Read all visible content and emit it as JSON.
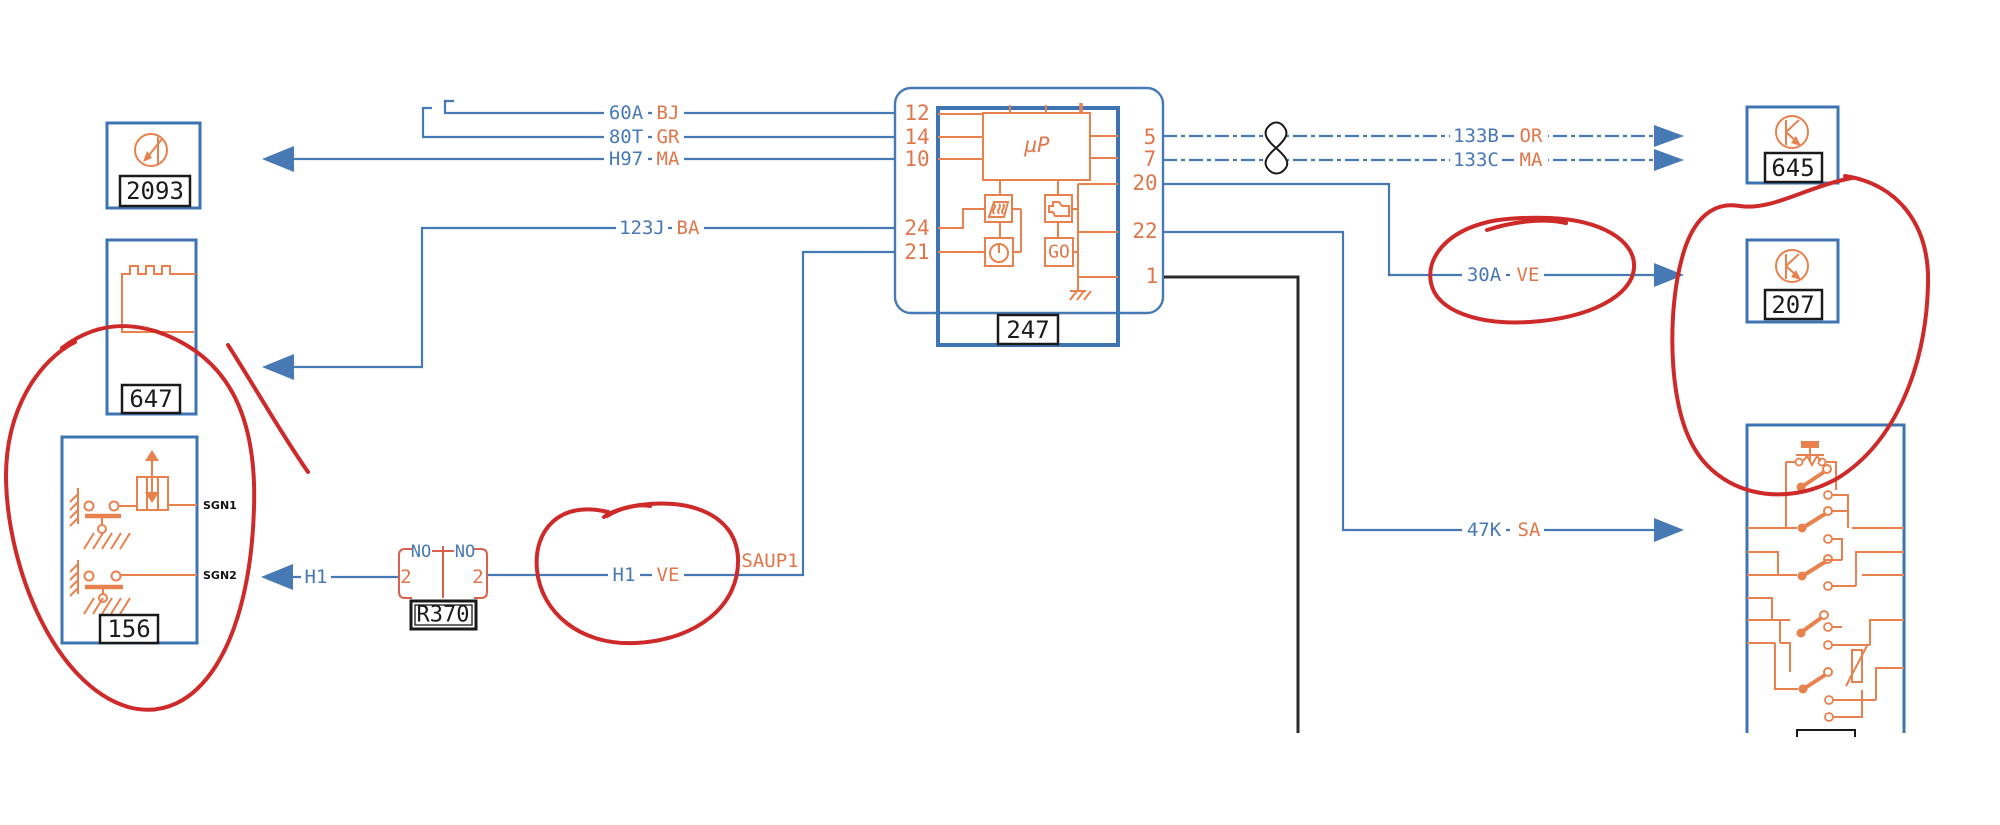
{
  "diagram": {
    "type": "automotive-wiring-schematic",
    "annotation_color": "#cf2a2a",
    "wire_color": "#4779b5",
    "component_color": "#e8814d"
  },
  "components": {
    "unit2093": {
      "id": "2093"
    },
    "unit647": {
      "id": "647"
    },
    "unit156": {
      "id": "156",
      "sgn1": "SGN1",
      "sgn2": "SGN2"
    },
    "unit247": {
      "id": "247",
      "cpu": "µP",
      "go": "GO",
      "pins_left": [
        "12",
        "14",
        "10",
        "24",
        "21"
      ],
      "pins_right": [
        "5",
        "7",
        "20",
        "22",
        "1"
      ]
    },
    "relay": {
      "id": "R370",
      "no_left": "NO",
      "no_right": "NO",
      "pin_left": "2",
      "pin_right": "2"
    },
    "unit645": {
      "id": "645"
    },
    "unit207": {
      "id": "207"
    }
  },
  "wires": {
    "w60a": {
      "code": "60A",
      "color": "BJ"
    },
    "w80t": {
      "code": "80T",
      "color": "GR"
    },
    "wh97": {
      "code": "H97",
      "color": "MA"
    },
    "w123j": {
      "code": "123J",
      "color": "BA"
    },
    "w133b": {
      "code": "133B",
      "color": "OR"
    },
    "w133c": {
      "code": "133C",
      "color": "MA"
    },
    "w30a": {
      "code": "30A",
      "color": "VE"
    },
    "w47k": {
      "code": "47K",
      "color": "SA"
    },
    "wh1": {
      "code": "H1"
    },
    "wh1ve": {
      "code": "H1",
      "color": "VE"
    },
    "wsaup1": {
      "code": "SAUP1"
    }
  }
}
